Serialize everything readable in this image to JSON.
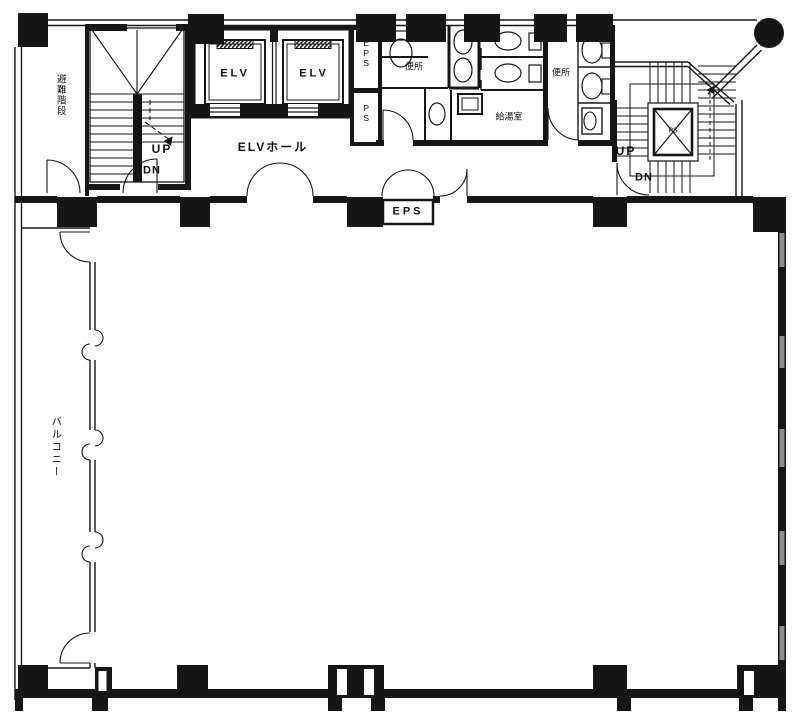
{
  "title": "建物平面図",
  "colors": {
    "line": "#161616",
    "bg": "#ffffff",
    "window_gray": "#8f8f8f"
  },
  "labels": {
    "escape_stairs": "避難階段",
    "left_stair_up": "UP",
    "left_stair_dn": "DN",
    "elevator_1": "ELV",
    "elevator_2": "ELV",
    "elevator_hall": "ELVホール",
    "eps_shaft": "EPS",
    "ps_shaft": "PS",
    "toilet_left": "便所",
    "toilet_right": "便所",
    "kitchenette": "給湯室",
    "eps_box": "EPS",
    "right_stair_up": "UP",
    "right_stair_dn": "DN",
    "right_stair_shaft": "PS",
    "balcony": "バルコニー"
  }
}
